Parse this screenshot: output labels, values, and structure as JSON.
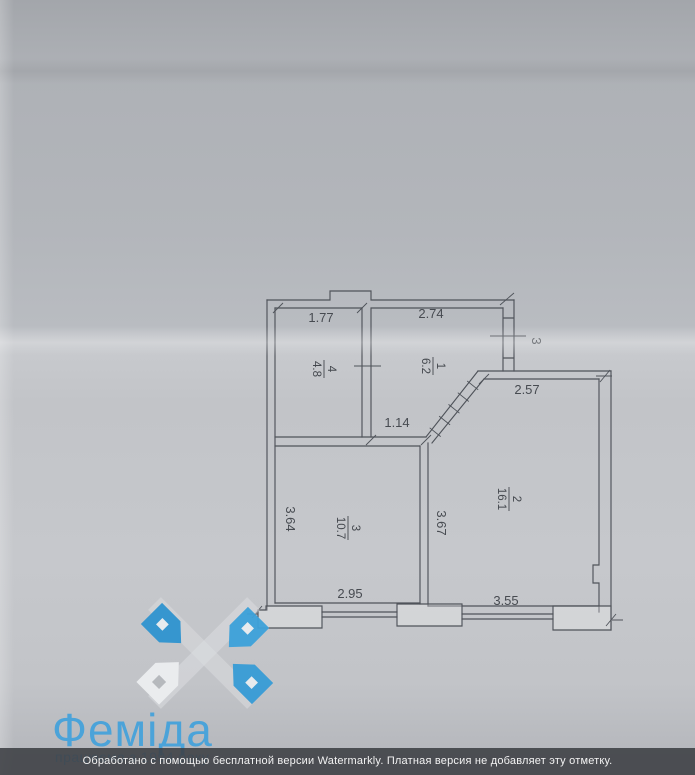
{
  "floor_plan": {
    "rooms": [
      {
        "number": "4",
        "area": "4.8"
      },
      {
        "number": "1",
        "area": "6.2"
      },
      {
        "number": "2",
        "area": "16.1"
      },
      {
        "number": "3",
        "area": "10.7"
      }
    ],
    "dimensions": {
      "room4_width": "1.77",
      "room1_width": "2.74",
      "right_upper": "3",
      "room2_top": "2.57",
      "hall_width": "1.14",
      "left_height": "3.64",
      "inner_height": "3.67",
      "room3_bottom": "2.95",
      "room2_bottom": "3.55"
    },
    "line_color": "#4f535a"
  },
  "logo": {
    "name": "Феміда",
    "tagline": "працюємо з 1994 року",
    "text_color": "#4ba3d9",
    "house_blue": "#379cd6",
    "house_white": "#edeff1"
  },
  "watermark": {
    "text": "Обработано с помощью бесплатной версии Watermarkly. Платная версия не добавляет эту отметку."
  }
}
